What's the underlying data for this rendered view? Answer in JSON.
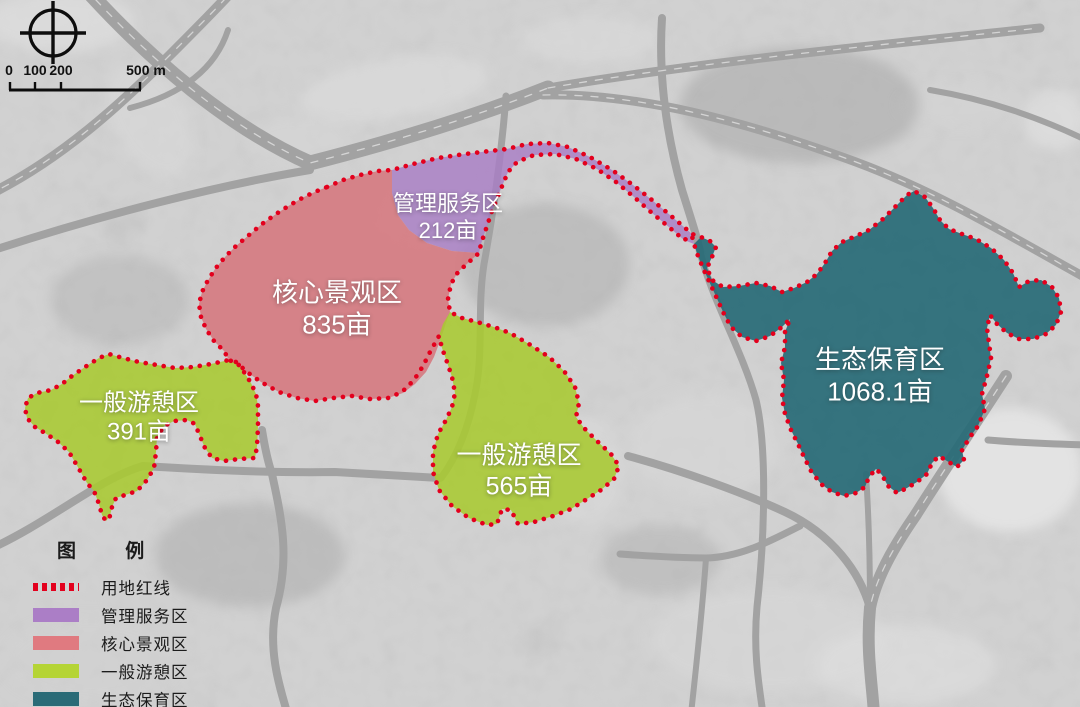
{
  "map": {
    "background_color": "#b5b5b5",
    "boundary_color": "#e3001d",
    "boundary_name": "用地红线"
  },
  "scale_bar": {
    "labels": [
      {
        "text": "0",
        "x": 9
      },
      {
        "text": "100",
        "x": 35
      },
      {
        "text": "200",
        "x": 61
      },
      {
        "text": "500 m",
        "x": 146
      }
    ]
  },
  "zones": [
    {
      "id": "management",
      "name": "管理服务区",
      "area": "212亩",
      "color": "#a87ec5",
      "label_x": 448,
      "label_y": 218,
      "font_px": 22
    },
    {
      "id": "core",
      "name": "核心景观区",
      "area": "835亩",
      "color": "#d6747b",
      "label_x": 337,
      "label_y": 309,
      "font_px": 26
    },
    {
      "id": "recreation_west",
      "name": "一般游憩区",
      "area": "391亩",
      "color": "#a9c931",
      "label_x": 139,
      "label_y": 418,
      "font_px": 24
    },
    {
      "id": "recreation_central",
      "name": "一般游憩区",
      "area": "565亩",
      "color": "#a9c931",
      "label_x": 519,
      "label_y": 471,
      "font_px": 25
    },
    {
      "id": "ecology",
      "name": "生态保育区",
      "area": "1068.1亩",
      "color": "#276a76",
      "label_x": 880,
      "label_y": 376,
      "font_px": 26
    }
  ],
  "legend": {
    "title": "图 例",
    "boundary_item": {
      "label": "用地红线",
      "color": "#e3001d"
    },
    "items": [
      {
        "label": "管理服务区",
        "color": "#ab7ec6"
      },
      {
        "label": "核心景观区",
        "color": "#e07a80"
      },
      {
        "label": "一般游憩区",
        "color": "#b5d435"
      },
      {
        "label": "生态保育区",
        "color": "#2a6b77"
      }
    ]
  }
}
